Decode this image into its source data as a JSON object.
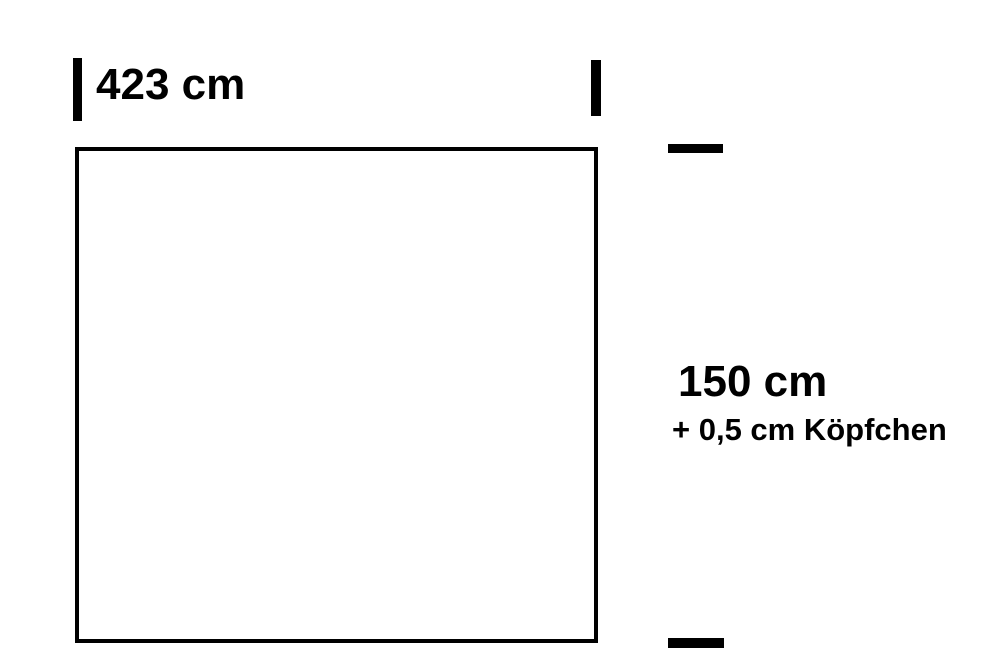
{
  "diagram": {
    "width_dimension": {
      "label": "423 cm"
    },
    "height_dimension": {
      "label": "150 cm",
      "note": "+ 0,5 cm Köpfchen"
    },
    "colors": {
      "line": "#000000",
      "text": "#000000",
      "background": "#ffffff"
    }
  }
}
